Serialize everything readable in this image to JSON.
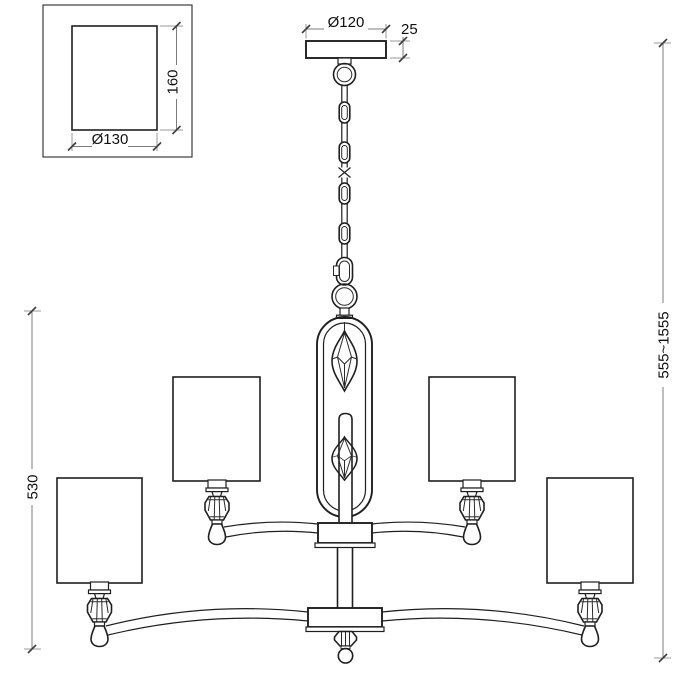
{
  "drawing": {
    "title": "chandelier-technical-drawing",
    "dimensions": {
      "canopy_diameter": "Ø120",
      "canopy_height": "25",
      "shade_height": "160",
      "shade_diameter": "Ø130",
      "body_height": "530",
      "overall_height": "555~1555"
    },
    "colors": {
      "line": "#1f1f1f",
      "dimension_line": "#7d7d7d",
      "extension_line": "#9a9a9a",
      "text": "#101010",
      "background": "#ffffff"
    }
  }
}
